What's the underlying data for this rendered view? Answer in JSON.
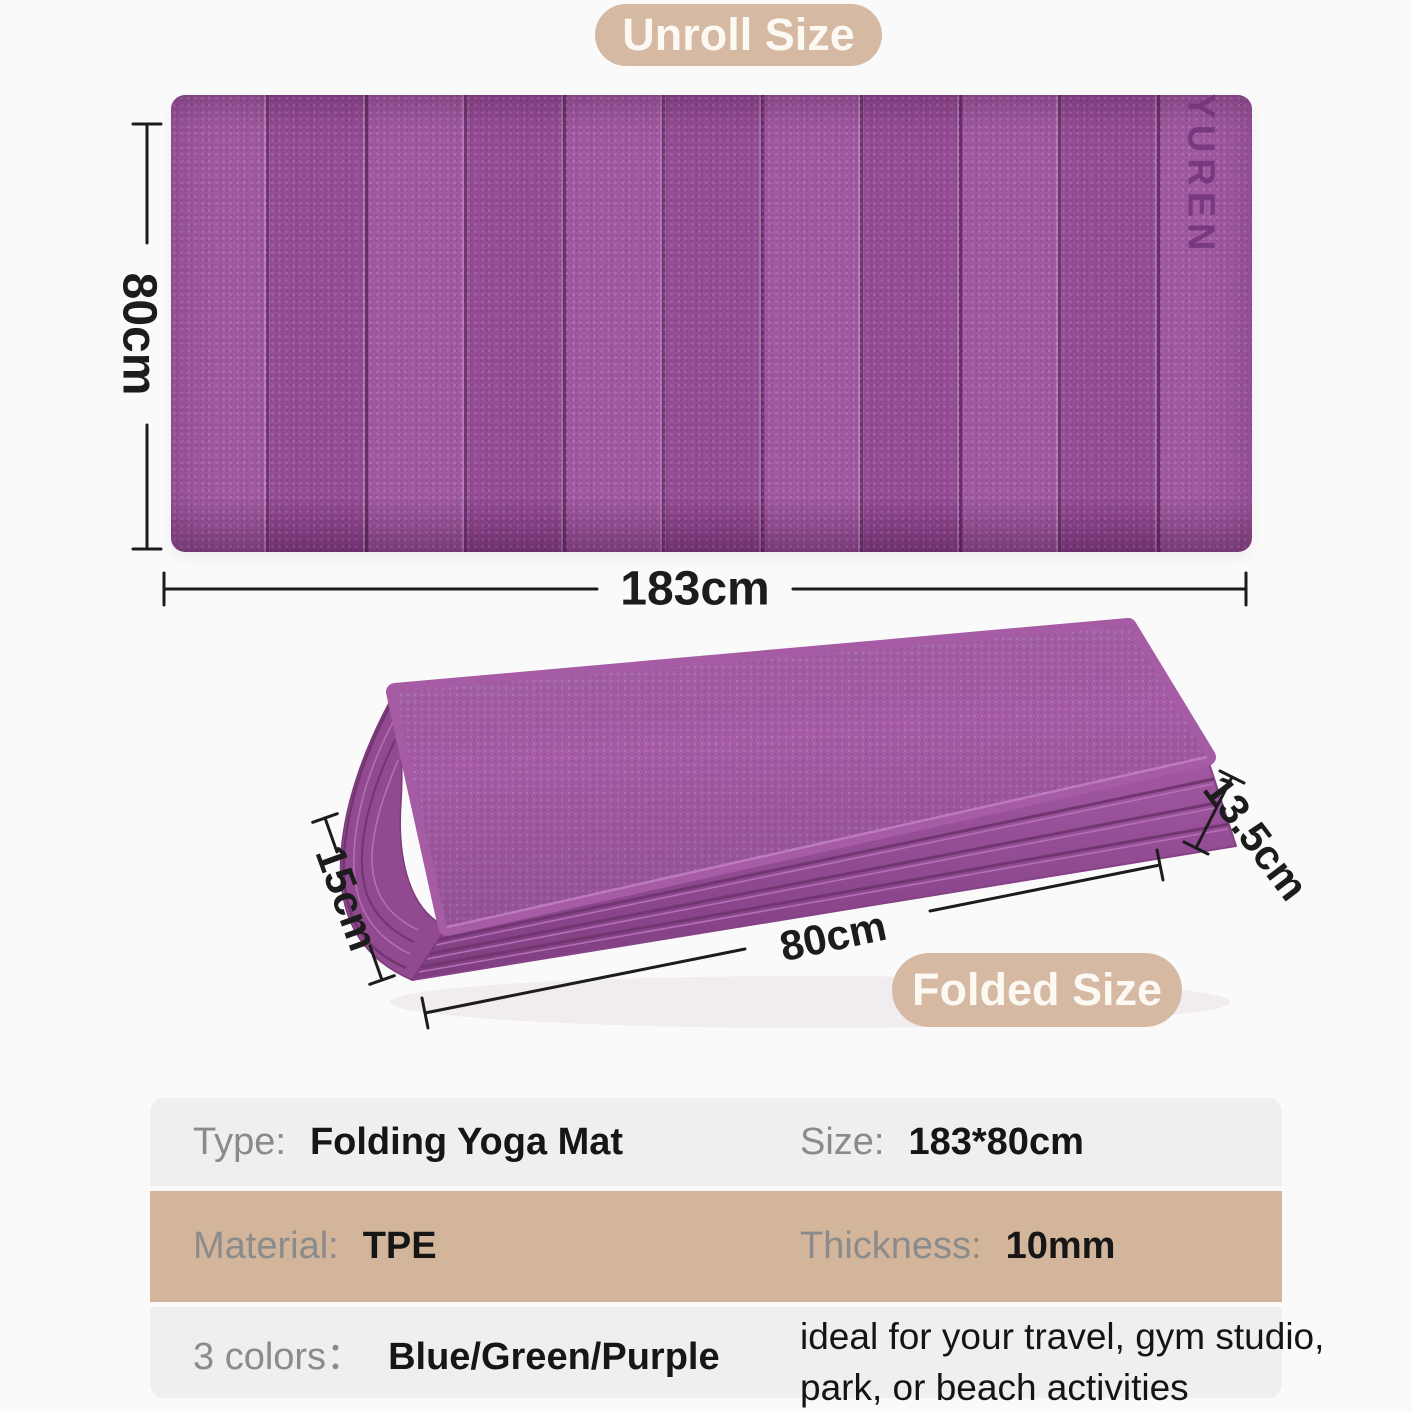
{
  "badges": {
    "unroll": "Unroll Size",
    "folded": "Folded Size"
  },
  "brand": {
    "logo": "YUREN"
  },
  "dimensions": {
    "unrolled_width": "183cm",
    "unrolled_height": "80cm",
    "folded_width": "15cm",
    "folded_length": "80cm",
    "folded_thickness": "13.5cm"
  },
  "table": {
    "rows": [
      {
        "left_label": "Type:",
        "left_value": "Folding Yoga Mat",
        "right_label": "Size:",
        "right_value": "183*80cm"
      },
      {
        "left_label": "Material:",
        "left_value": "TPE",
        "right_label": "Thickness:",
        "right_value": "10mm"
      },
      {
        "left_label": "3 colors：",
        "left_value": "Blue/Green/Purple",
        "note_line1": "ideal for your travel, gym studio,",
        "note_line2": "park, or beach activities"
      }
    ]
  },
  "colors": {
    "mat_purple": "#9c519c",
    "mat_purple_dark": "#7c3a7c",
    "badge_tan": "#d5b9a2",
    "row_tan": "#d3b59c",
    "row_gray": "#f0eff0",
    "dimension_ink": "#1c1c1c"
  }
}
